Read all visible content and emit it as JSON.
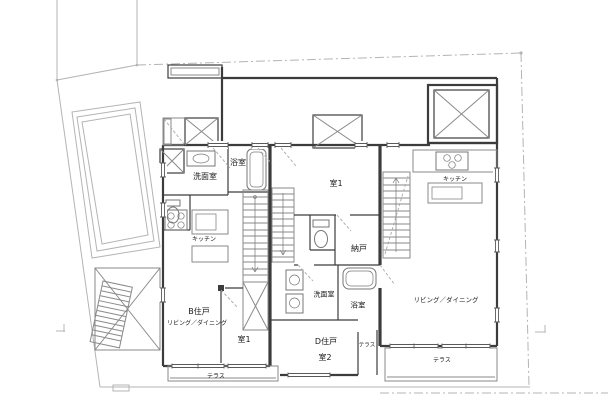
{
  "drawing": {
    "type": "japanese-apartment-floor-plan",
    "labels": [
      {
        "id": "label-bath-b",
        "text": "浴室",
        "x": 238,
        "y": 163,
        "size": 8
      },
      {
        "id": "label-washroom-b",
        "text": "洗面室",
        "x": 205,
        "y": 177,
        "size": 8
      },
      {
        "id": "label-kitchen-b",
        "text": "キッチン",
        "x": 204,
        "y": 240,
        "size": 6
      },
      {
        "id": "label-room1-d",
        "text": "室1",
        "x": 336,
        "y": 184,
        "size": 8
      },
      {
        "id": "label-storage-d",
        "text": "納戸",
        "x": 359,
        "y": 249,
        "size": 8
      },
      {
        "id": "label-kitchen-r",
        "text": "キッチン",
        "x": 455,
        "y": 180,
        "size": 6
      },
      {
        "id": "label-living-r",
        "text": "リビング／ダイニング",
        "x": 446,
        "y": 300,
        "size": 6.5
      },
      {
        "id": "label-terrace-r",
        "text": "テラス",
        "x": 442,
        "y": 361,
        "size": 6
      },
      {
        "id": "label-unit-b",
        "text": "B住戸",
        "x": 199,
        "y": 312,
        "size": 8
      },
      {
        "id": "label-living-b",
        "text": "リビング／ダイニング",
        "x": 197,
        "y": 324,
        "size": 6
      },
      {
        "id": "label-room1-b",
        "text": "室1",
        "x": 244,
        "y": 340,
        "size": 8
      },
      {
        "id": "label-terrace-b",
        "text": "テラス",
        "x": 216,
        "y": 377,
        "size": 6
      },
      {
        "id": "label-washroom-d",
        "text": "洗面室",
        "x": 324,
        "y": 295,
        "size": 7
      },
      {
        "id": "label-bath-d",
        "text": "浴室",
        "x": 358,
        "y": 305,
        "size": 7.5
      },
      {
        "id": "label-unit-d",
        "text": "D住戸",
        "x": 326,
        "y": 342,
        "size": 8
      },
      {
        "id": "label-room2-d",
        "text": "室2",
        "x": 325,
        "y": 358,
        "size": 8
      },
      {
        "id": "label-terrace-d",
        "text": "テラス",
        "x": 367,
        "y": 346,
        "size": 5.5
      }
    ],
    "colors": {
      "background": "#ffffff",
      "wall": "#3c3c3c",
      "line_light": "#8a8a8a",
      "site_line": "#b4b4b4",
      "fixture": "#777777",
      "text": "#1a1a1a"
    }
  }
}
